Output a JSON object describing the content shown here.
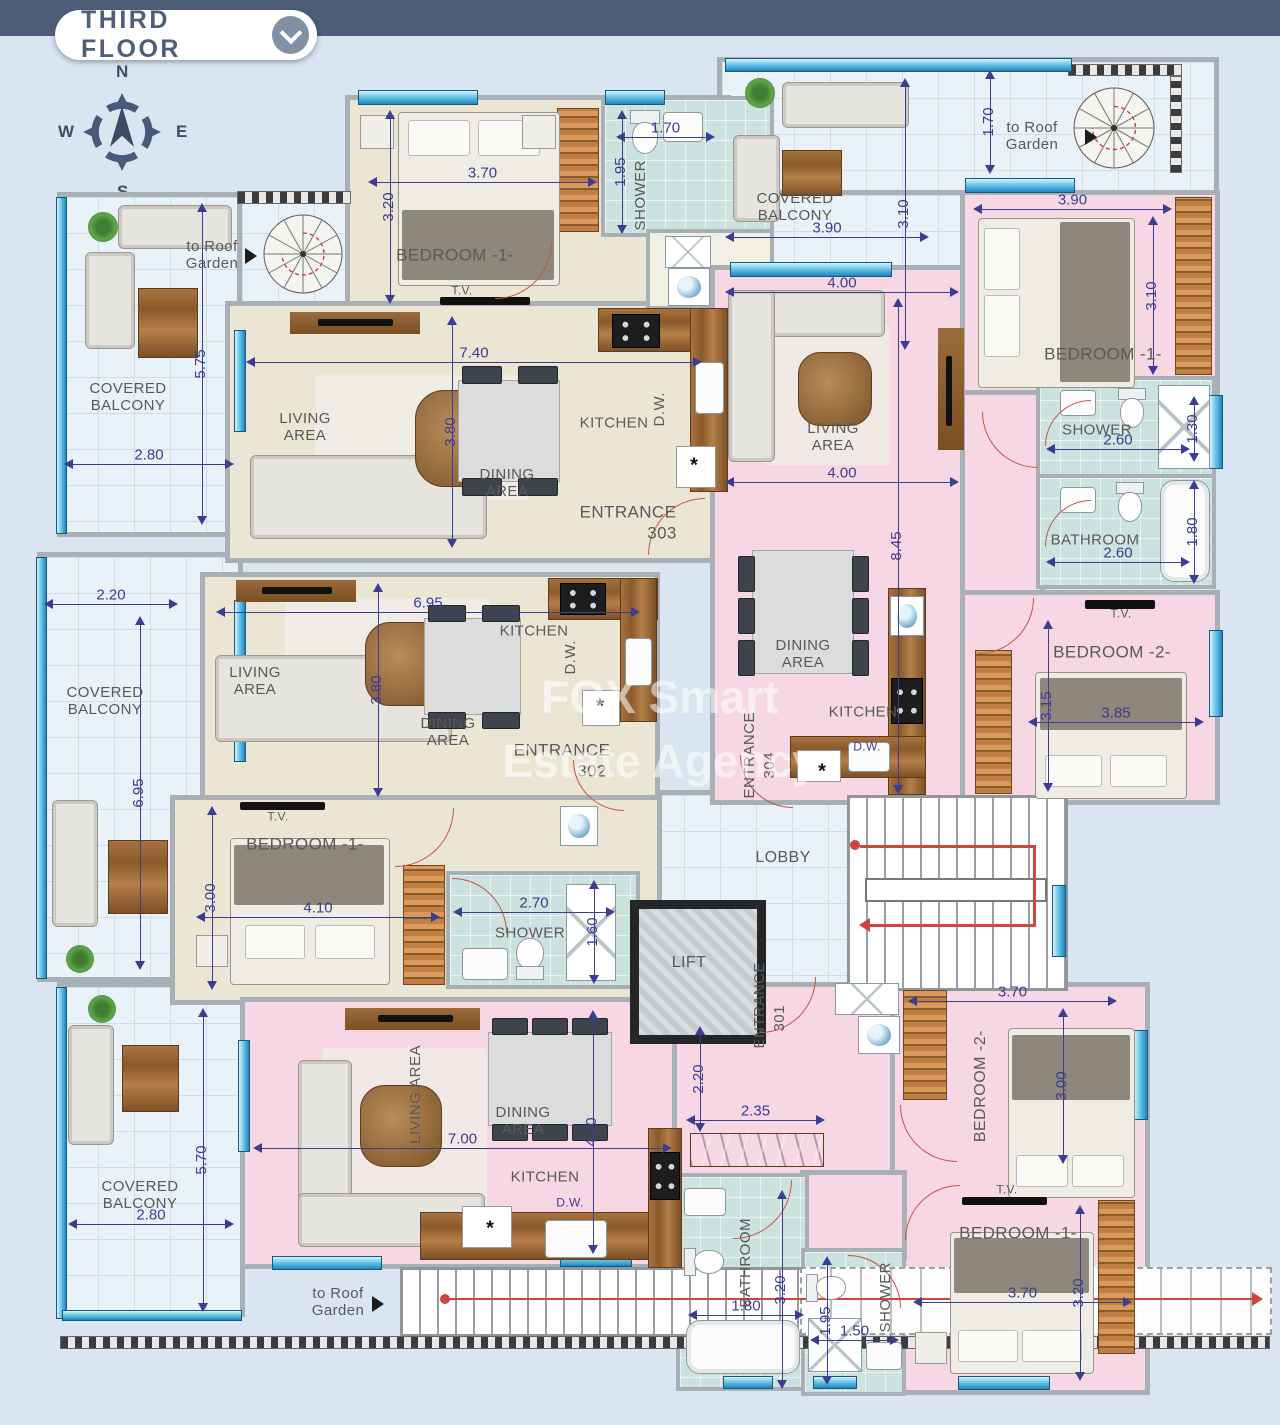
{
  "header": {
    "title": "THIRD FLOOR"
  },
  "compass": {
    "n": "N",
    "e": "E",
    "s": "S",
    "w": "W"
  },
  "watermark": {
    "line1": "FOX Smart",
    "line2": "Estate Agency"
  },
  "common": {
    "lobby": "LOBBY",
    "lift": "LIFT",
    "roof_garden": "to Roof Garden"
  },
  "colors": {
    "header_bar": "#4E5D78",
    "dimension": "#3C3C92",
    "apartment_cream": "#EBE6D4",
    "apartment_pink": "#F6D7E3",
    "balcony_tile": "#E9F2F9",
    "bathroom_teal": "#CBE2DF",
    "wall_gray": "#A8AFB5",
    "stair_route_red": "#D0453C"
  },
  "balconies": {
    "top_left": {
      "label": "COVERED BALCONY",
      "w": "2.80",
      "h": "5.75"
    },
    "mid_left": {
      "label": "COVERED BALCONY",
      "w": "2.20",
      "h": "6.95"
    },
    "bottom_left": {
      "label": "COVERED BALCONY",
      "w": "2.80",
      "h": "5.70"
    },
    "top_right": {
      "label": "COVERED BALCONY",
      "w": "3.90",
      "h": "3.10",
      "upper": "1.70"
    }
  },
  "apt303": {
    "entrance": "ENTRANCE",
    "no": "303",
    "bedroom1": {
      "label": "BEDROOM -1-",
      "w": "3.70",
      "h": "3.20",
      "tv": "T.V."
    },
    "shower": {
      "label": "SHOWER",
      "w": "1.70",
      "h": "1.95"
    },
    "living": {
      "label": "LIVING AREA",
      "w": "7.40",
      "h": "3.80"
    },
    "dining": {
      "label": "DINING AREA"
    },
    "kitchen": {
      "label": "KITCHEN",
      "dw": "D.W.",
      "sink": "*"
    }
  },
  "apt302": {
    "entrance": "ENTRANCE",
    "no": "302",
    "living": {
      "label": "LIVING AREA",
      "w": "6.95",
      "h": "3.80"
    },
    "dining": {
      "label": "DINING AREA"
    },
    "kitchen": {
      "label": "KITCHEN",
      "dw": "D.W.",
      "sink": "*"
    },
    "bedroom1": {
      "label": "BEDROOM -1-",
      "w": "4.10",
      "h": "3.00",
      "tv": "T.V."
    },
    "shower": {
      "label": "SHOWER",
      "w": "2.70",
      "h": "1.60"
    }
  },
  "apt304": {
    "entrance": "ENTRANCE",
    "no": "304",
    "bedroom1": {
      "label": "BEDROOM -1-",
      "w": "3.90",
      "h": "3.10"
    },
    "shower": {
      "label": "SHOWER",
      "w": "2.60",
      "h": "1.30"
    },
    "bathroom": {
      "label": "BATHROOM",
      "w": "2.60",
      "h": "1.80"
    },
    "living": {
      "label": "LIVING AREA",
      "w_top": "4.00",
      "w_mid": "4.00",
      "h": "8.45"
    },
    "dining": {
      "label": "DINING AREA"
    },
    "kitchen": {
      "label": "KITCHEN",
      "dw": "D.W.",
      "sink": "*"
    },
    "bedroom2": {
      "label": "BEDROOM -2-",
      "w": "3.85",
      "h": "3.15",
      "tv": "T.V."
    }
  },
  "apt301": {
    "entrance": "ENTRANCE",
    "no": "301",
    "living": {
      "label": "LIVING AREA",
      "w": "7.00",
      "h": "4.10"
    },
    "dining": {
      "label": "DINING AREA"
    },
    "kitchen": {
      "label": "KITCHEN",
      "dw": "D.W.",
      "sink": "*"
    },
    "hall": {
      "w": "2.35",
      "h": "2.20"
    },
    "bathroom": {
      "label": "BATHROOM",
      "w": "1.80",
      "h": "3.20"
    },
    "shower": {
      "label": "SHOWER",
      "w": "1.50",
      "h": "1.95"
    },
    "bedroom2": {
      "label": "BEDROOM -2-",
      "w": "3.70",
      "h": "3.00"
    },
    "bedroom1": {
      "label": "BEDROOM -1-",
      "w": "3.70",
      "h": "3.20",
      "tv": "T.V."
    }
  }
}
